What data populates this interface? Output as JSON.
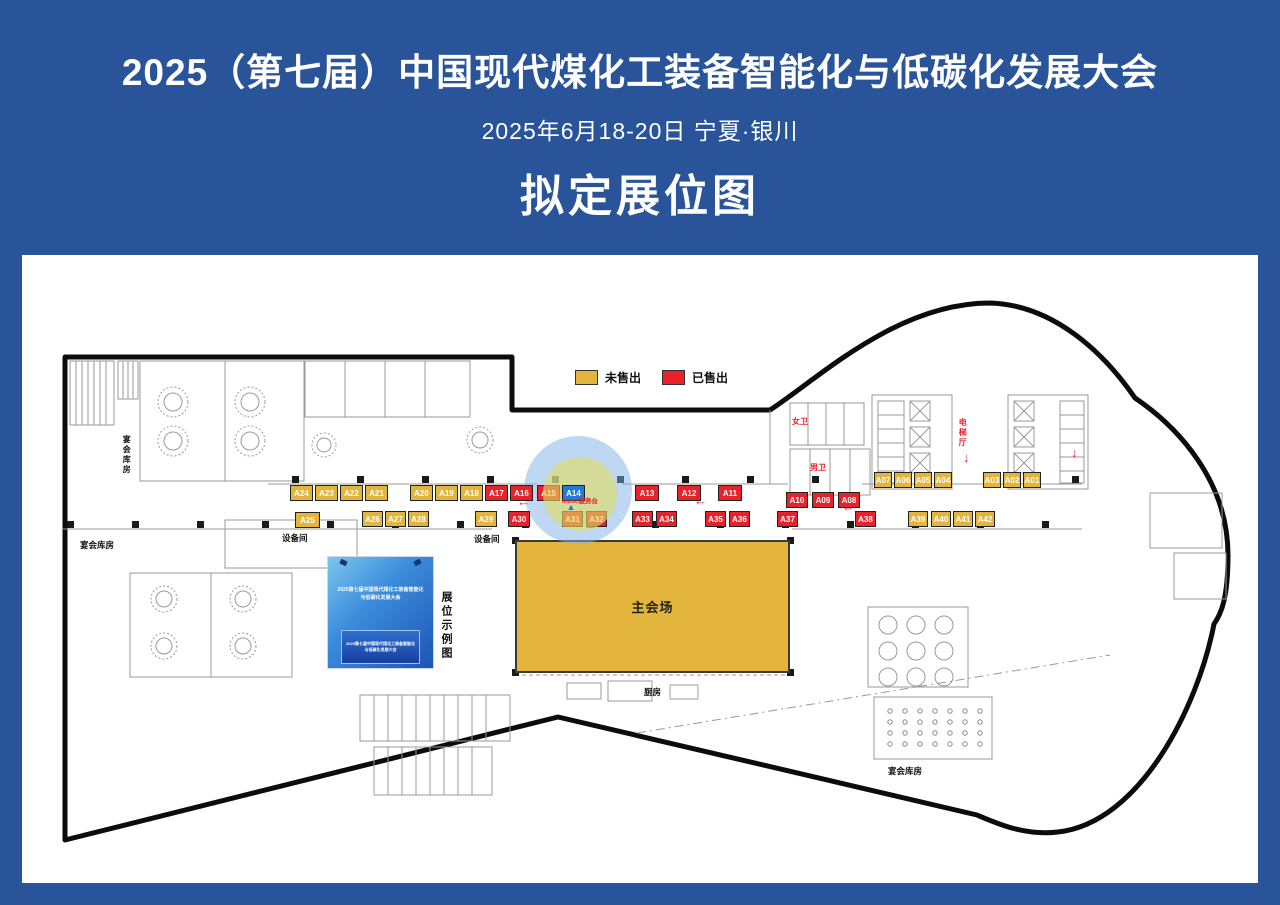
{
  "header": {
    "title": "2025（第七届）中国现代煤化工装备智能化与低碳化发展大会",
    "date_location": "2025年6月18-20日  宁夏·银川",
    "map_title": "拟定展位图"
  },
  "legend": {
    "unsold_label": "未售出",
    "sold_label": "已售出",
    "unsold_color": "#E4B53C",
    "sold_color": "#E8222B"
  },
  "icons": {
    "left_arrow": "←",
    "down_arrow": "↓",
    "marker_triangle": "▲"
  },
  "map": {
    "main_hall_label": "主会场",
    "booth_example_label": "展位示例图",
    "backdrop_title": "2025第七届中国现代煤化工装备智能化与低碳化发展大会",
    "podium_text": "2025第七届中国现代煤化工装备智能化与低碳化发展大会",
    "selected_booth": {
      "id": "A14",
      "color": "#1F7BDD",
      "note": "inzoc服务台"
    },
    "rooms": [
      {
        "id": "banquet-store-1",
        "label": "宴会库房"
      },
      {
        "id": "banquet-store-2",
        "label": "宴会库房"
      },
      {
        "id": "banquet-store-3",
        "label": "宴会库房"
      },
      {
        "id": "equipment-room-1",
        "label": "设备间"
      },
      {
        "id": "equipment-room-2",
        "label": "设备间"
      },
      {
        "id": "kitchen",
        "label": "厨房"
      },
      {
        "id": "womens-restroom",
        "label": "女卫"
      },
      {
        "id": "mens-restroom",
        "label": "男卫"
      },
      {
        "id": "elevator-hall",
        "label": "电梯厅"
      }
    ]
  },
  "booths": [
    {
      "id": "A01",
      "status": "available"
    },
    {
      "id": "A02",
      "status": "available"
    },
    {
      "id": "A03",
      "status": "available"
    },
    {
      "id": "A04",
      "status": "available"
    },
    {
      "id": "A05",
      "status": "available"
    },
    {
      "id": "A06",
      "status": "available"
    },
    {
      "id": "A07",
      "status": "available"
    },
    {
      "id": "A08",
      "status": "sold"
    },
    {
      "id": "A09",
      "status": "sold"
    },
    {
      "id": "A10",
      "status": "sold"
    },
    {
      "id": "A11",
      "status": "sold"
    },
    {
      "id": "A12",
      "status": "sold"
    },
    {
      "id": "A13",
      "status": "sold"
    },
    {
      "id": "A14",
      "status": "selected"
    },
    {
      "id": "A15",
      "status": "sold"
    },
    {
      "id": "A16",
      "status": "sold"
    },
    {
      "id": "A17",
      "status": "sold"
    },
    {
      "id": "A18",
      "status": "available"
    },
    {
      "id": "A19",
      "status": "available"
    },
    {
      "id": "A20",
      "status": "available"
    },
    {
      "id": "A21",
      "status": "available"
    },
    {
      "id": "A22",
      "status": "available"
    },
    {
      "id": "A23",
      "status": "available"
    },
    {
      "id": "A24",
      "status": "available"
    },
    {
      "id": "A25",
      "status": "available"
    },
    {
      "id": "A26",
      "status": "available"
    },
    {
      "id": "A27",
      "status": "available"
    },
    {
      "id": "A28",
      "status": "available"
    },
    {
      "id": "A29",
      "status": "available"
    },
    {
      "id": "A30",
      "status": "sold"
    },
    {
      "id": "A31",
      "status": "sold"
    },
    {
      "id": "A32",
      "status": "sold"
    },
    {
      "id": "A33",
      "status": "sold"
    },
    {
      "id": "A34",
      "status": "sold"
    },
    {
      "id": "A35",
      "status": "sold"
    },
    {
      "id": "A36",
      "status": "sold"
    },
    {
      "id": "A37",
      "status": "sold"
    },
    {
      "id": "A38",
      "status": "sold"
    },
    {
      "id": "A39",
      "status": "available"
    },
    {
      "id": "A40",
      "status": "available"
    },
    {
      "id": "A41",
      "status": "available"
    },
    {
      "id": "A42",
      "status": "available"
    }
  ]
}
